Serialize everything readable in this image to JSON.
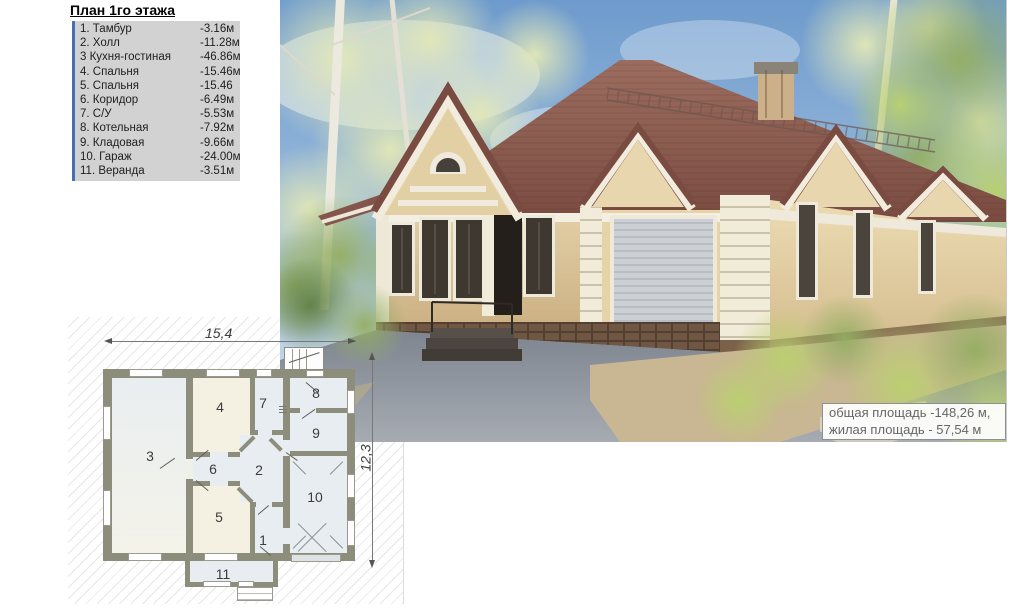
{
  "legend": {
    "title": "План 1го этажа",
    "items": [
      {
        "name": "1. Тамбур",
        "area": "-3.16м"
      },
      {
        "name": "2. Холл",
        "area": "-11.28м"
      },
      {
        "name": "3 Кухня-гостиная",
        "area": "-46.86м"
      },
      {
        "name": "4. Спальня",
        "area": "-15.46м"
      },
      {
        "name": "5. Спальня",
        "area": "-15.46"
      },
      {
        "name": "6. Коридор",
        "area": "-6.49м"
      },
      {
        "name": "7. С/У",
        "area": "-5.53м"
      },
      {
        "name": "8. Котельная",
        "area": "-7.92м"
      },
      {
        "name": "9. Кладовая",
        "area": "-9.66м"
      },
      {
        "name": "10. Гараж",
        "area": "-24.00м"
      },
      {
        "name": "11. Веранда",
        "area": "-3.51м"
      }
    ]
  },
  "photo": {
    "area_summary": {
      "line1": "общая площадь -148,26 м,",
      "line2": "жилая площадь - 57,54 м"
    }
  },
  "plan": {
    "dimensions": {
      "width_label": "15,4",
      "height_label": "12,3"
    },
    "room_numbers": {
      "r1": "1",
      "r2": "2",
      "r3": "3",
      "r4": "4",
      "r5": "5",
      "r6": "6",
      "r7": "7",
      "r8": "8",
      "r9": "9",
      "r10": "10",
      "r11": "11"
    }
  },
  "colors": {
    "legend_accent": "#4472b0",
    "plan_wall": "#8d8d7c",
    "roof": "#8a594e",
    "facade": "#ddc79e",
    "sky": "#6e9bcd"
  }
}
